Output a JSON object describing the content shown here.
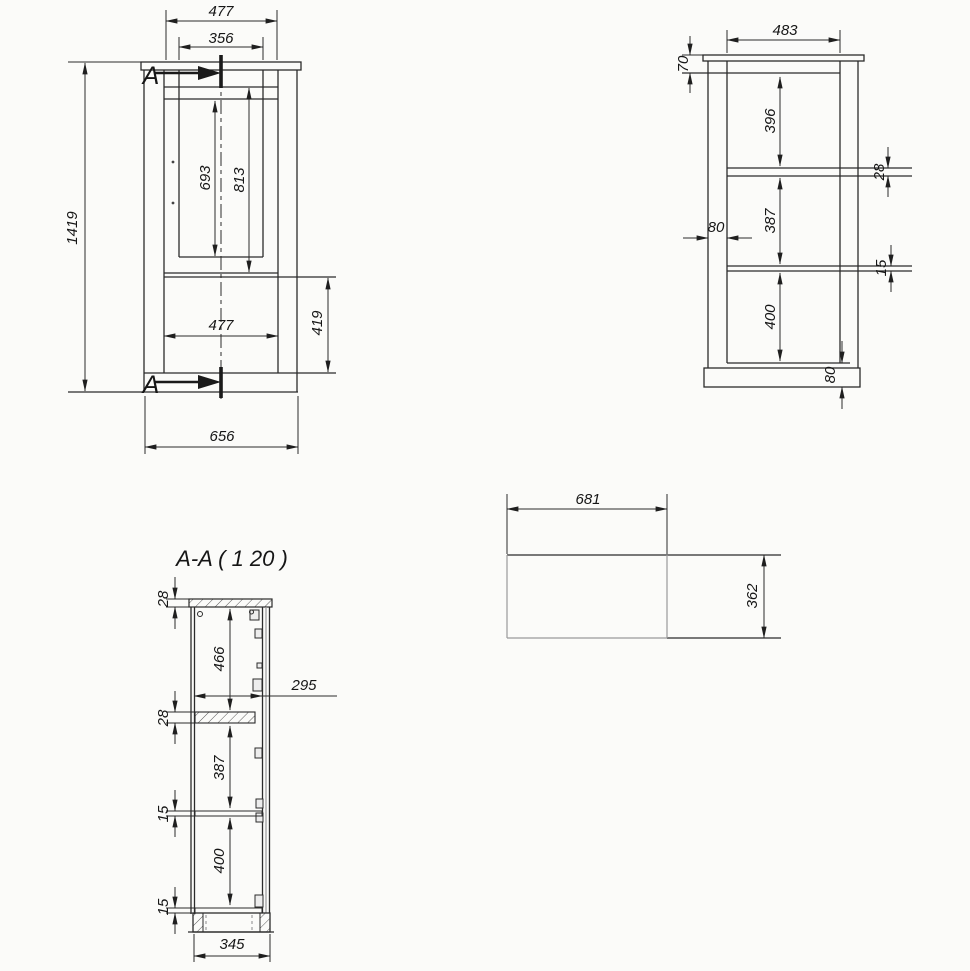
{
  "drawing": {
    "type": "furniture cabinet technical drawing",
    "background": "#fbfbf9",
    "line_color": "#2b2b2b",
    "front_view": {
      "section_label_top": "A",
      "section_label_bottom": "A",
      "dims": {
        "top_width": "477",
        "opening_width": "356",
        "opening_height": "693",
        "niche_height": "813",
        "overall_height": "1419",
        "door_width": "477",
        "door_height": "419",
        "overall_width": "656"
      }
    },
    "side_view": {
      "dims": {
        "top_width": "483",
        "top_rail_height": "70",
        "space_top": "396",
        "shelf_thickness_top": "28",
        "side_inset": "80",
        "space_mid": "387",
        "shelf_thickness_mid": "15",
        "space_bottom": "400",
        "plinth_height": "80"
      }
    },
    "plan_view": {
      "dims": {
        "width": "681",
        "depth": "362"
      }
    },
    "section_view": {
      "title": "A-A ( 1  20 )",
      "dims": {
        "top_panel_thickness": "28",
        "space_top": "466",
        "inner_depth": "295",
        "shelf_thickness": "28",
        "space_mid": "387",
        "shelf2_thickness": "15",
        "space_bottom": "400",
        "bottom_panel_thickness": "15",
        "plinth_width": "345"
      }
    }
  }
}
